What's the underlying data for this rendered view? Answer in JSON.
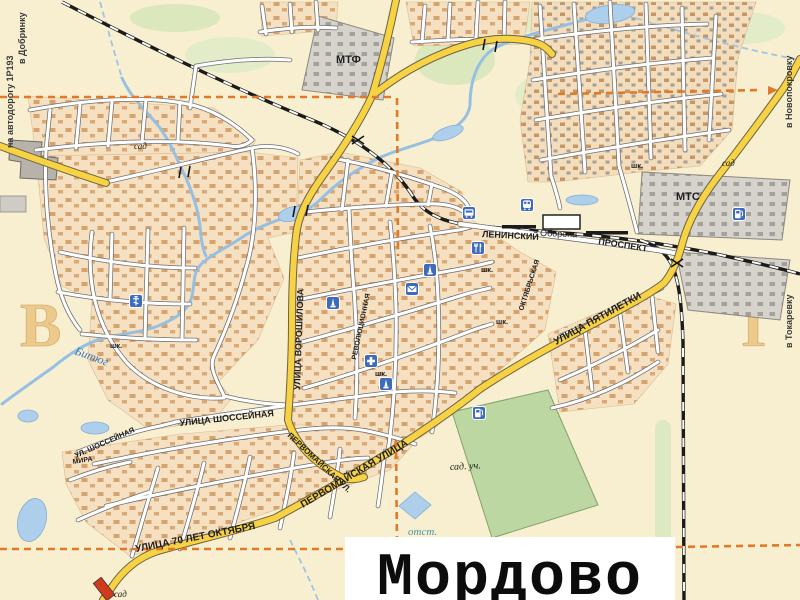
{
  "title": {
    "text": "Мордово"
  },
  "grid_letters": {
    "west": "В",
    "east": "Г"
  },
  "edge_labels": {
    "left_line1": "на автодорогу 1Р193",
    "left_line2": "в Добринку",
    "top_right": "в Новопокровку",
    "right": "в Токаревку"
  },
  "streets": {
    "voroshilova": "УЛИЦА ВОРОШИЛОВА",
    "leninsky": "ЛЕНИНСКИЙ",
    "prospekt": "ПРОСПЕКТ",
    "oborona": "Оборона",
    "pyatiletki": "УЛИЦА ПЯТИЛЕТКИ",
    "shosseynaya": "УЛИЦА ШОССЕЙНАЯ",
    "shosseynaya_short": "УЛ. ШОССЕЙНАЯ",
    "pervomayskaya": "ПЕРВОМАЙСКАЯ УЛИЦА",
    "pervomayskaya_short": "ПЕРВОМАЙСКАЯ УЛ.",
    "oktyabrya_70": "УЛИЦА 70 ЛЕТ ОКТЯБРЯ",
    "mira": "МИРА",
    "revolyutsionnaya": "РЕВОЛЮЦИОННАЯ",
    "oktyabrskaya": "ОКТЯБРЬСКАЯ"
  },
  "places": {
    "mtf": "МТФ",
    "mts": "МТС",
    "sad": "сад",
    "sad_uch": "сад. уч.",
    "otst": "отст.",
    "school": "шк.",
    "river": "Битюг"
  },
  "icons": {
    "church": "orthodox-church",
    "hospital": "hospital-cross",
    "monument": "monument-obelisk",
    "mail": "post-office-envelope",
    "train_station": "railway-station",
    "bus_station": "bus-station",
    "restaurant": "fork-knife",
    "fuel": "gas-station"
  },
  "colors": {
    "background": "#f8efd0",
    "main_road": "#f7d243",
    "minor_road": "#ffffff",
    "built_area": "#f5e1c2",
    "water": "#9cc5e6",
    "greenery": "#cfe2ad",
    "industrial": "#d6d3cd",
    "railway": "#1b1b1b",
    "boundary": "#e07a28",
    "icon_blue": "#3e6cbb",
    "grid_letter": "#e9bd77"
  }
}
